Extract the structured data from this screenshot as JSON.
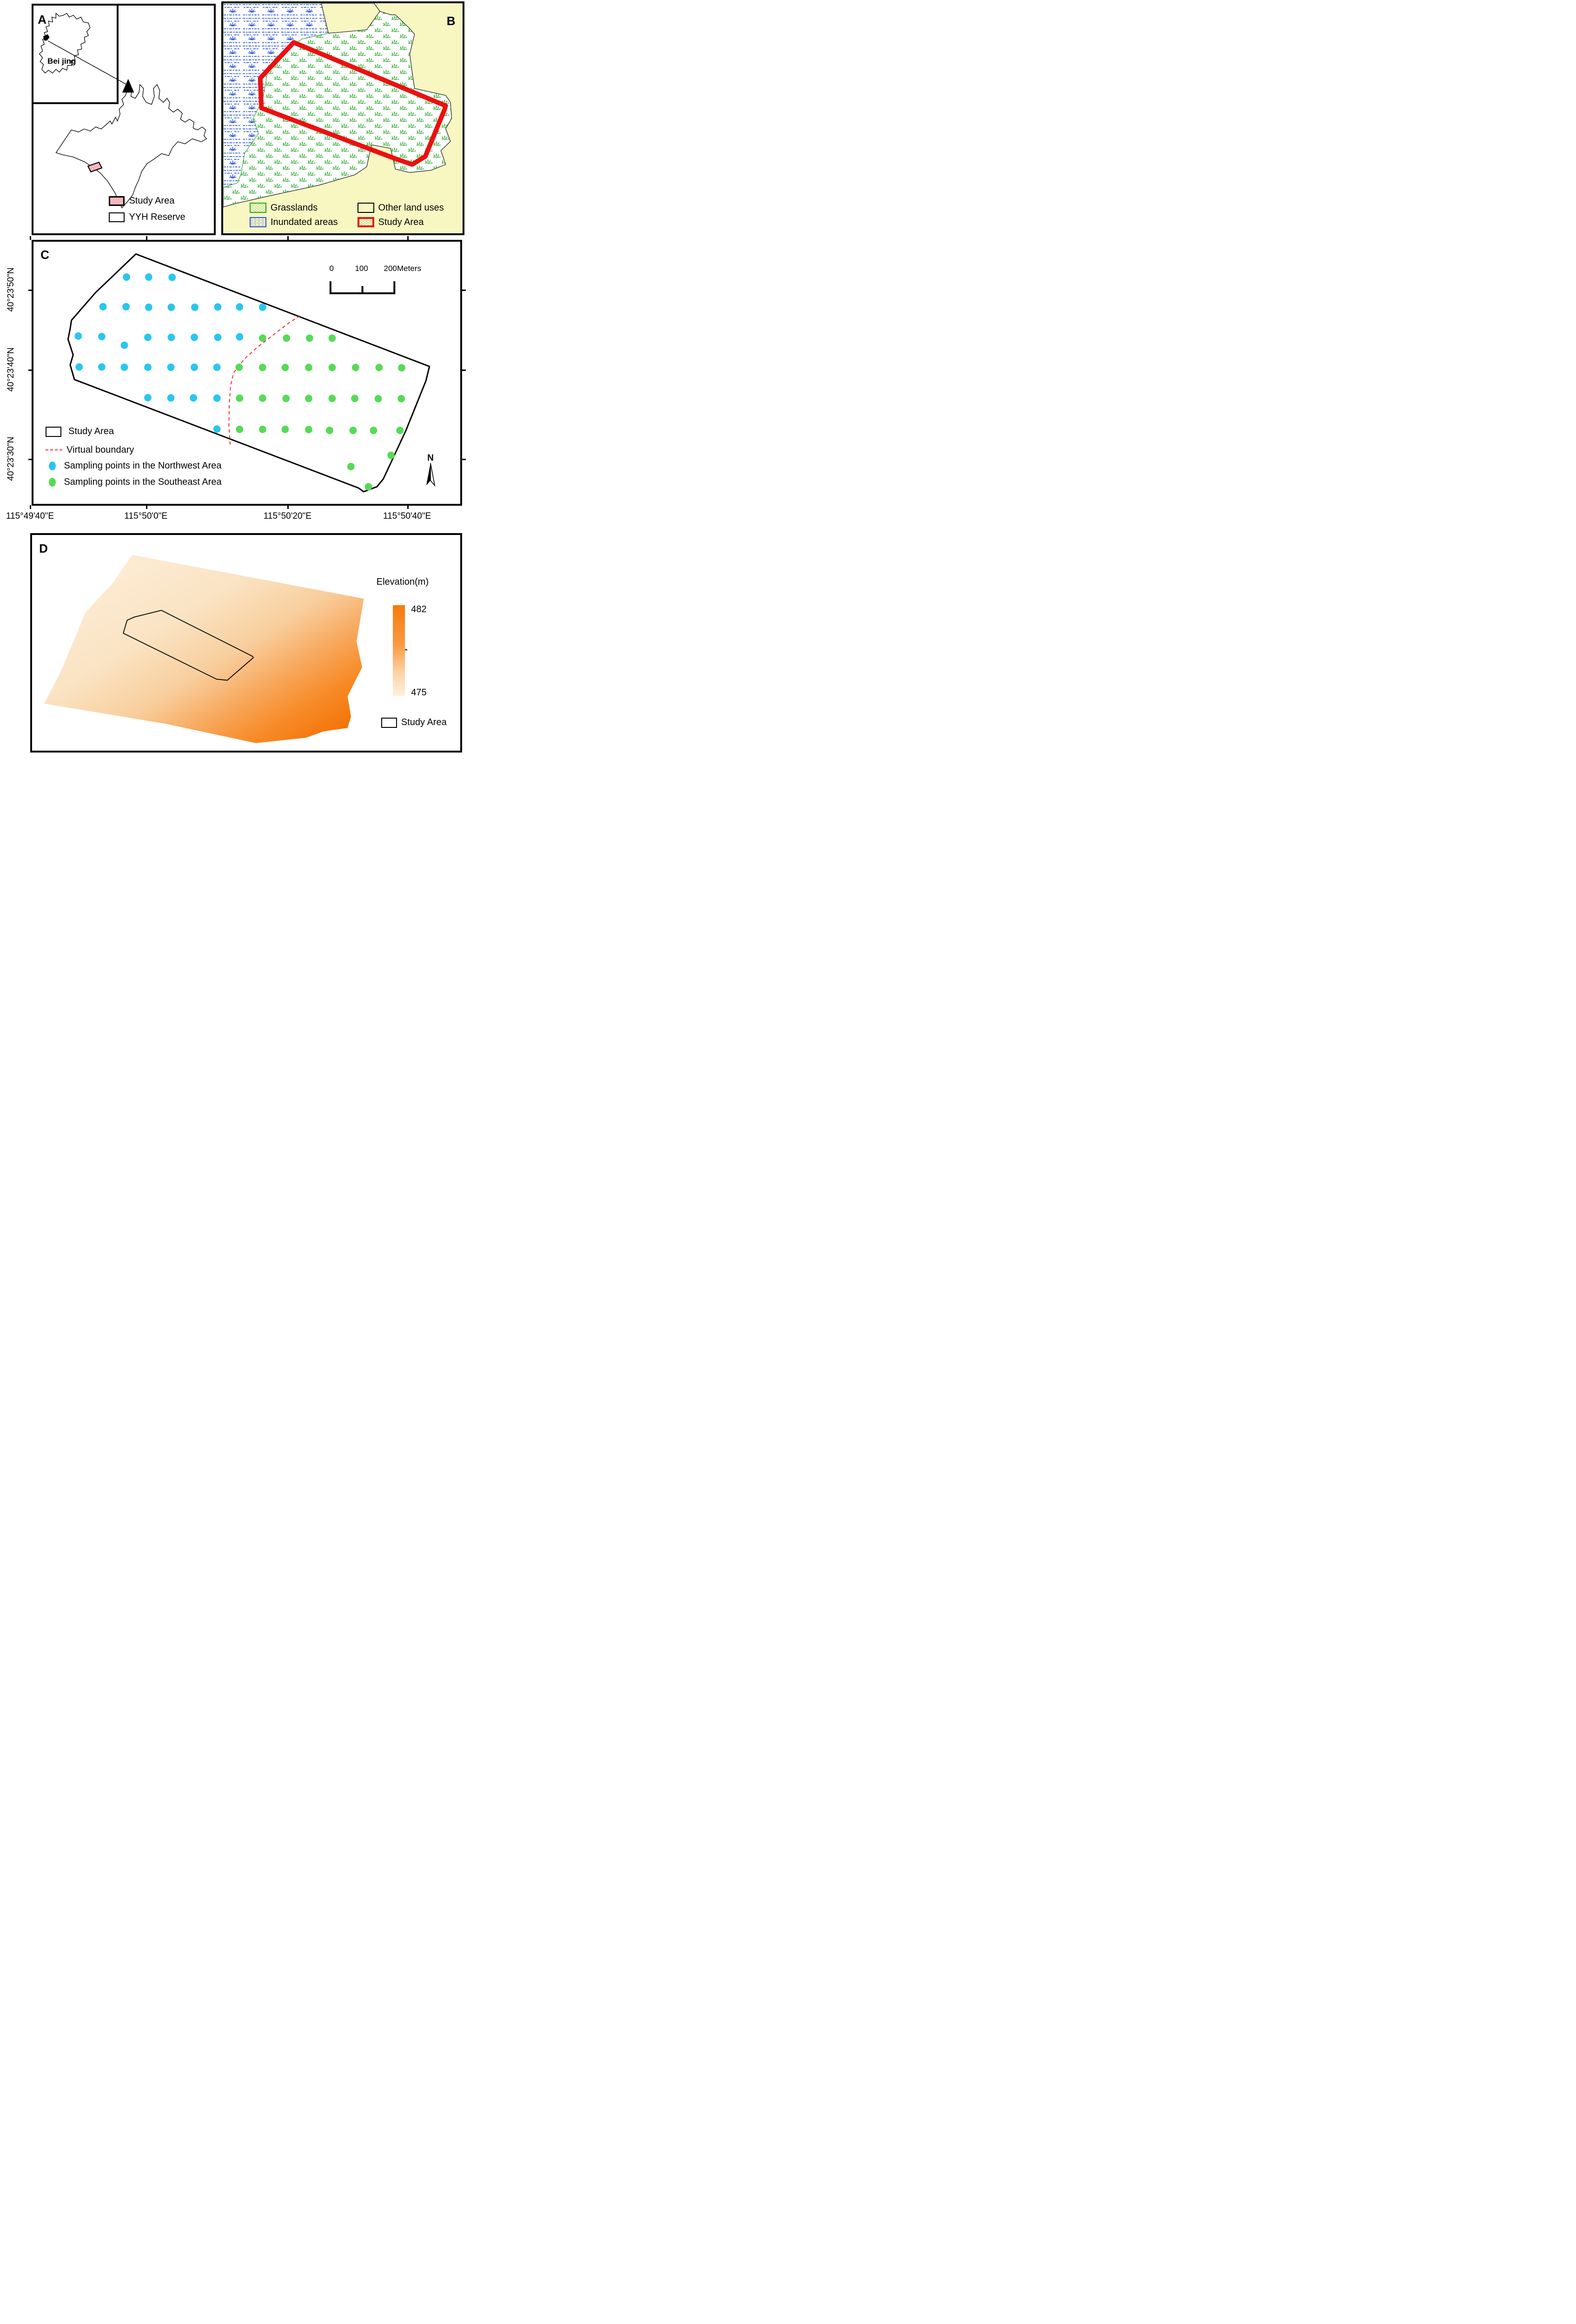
{
  "colors": {
    "page_bg": "#ffffff",
    "panel_b_bg": "#F8F7C2",
    "study_pink": "#F6B6BB",
    "grass_green": "#1FA41F",
    "marsh_blue": "#2A52D8",
    "study_red": "#EC1010",
    "virtual_red": "#FF2A2A",
    "nw_cyan": "#29C6F0",
    "se_green": "#55DB55",
    "elev_high": "#F3750A",
    "elev_low": "#FDEFDC"
  },
  "panel_a": {
    "letter": "A",
    "inset_label": "Bei jing",
    "legend": [
      {
        "label": "Study Area"
      },
      {
        "label": "YYH Reserve"
      }
    ]
  },
  "panel_b": {
    "letter": "B",
    "legend": [
      {
        "label": "Grasslands"
      },
      {
        "label": "Inundated areas"
      },
      {
        "label": "Other land uses"
      },
      {
        "label": "Study Area"
      }
    ]
  },
  "panel_c": {
    "letter": "C",
    "north_label": "N",
    "scale_bar": {
      "labels": [
        "0",
        "100",
        "200"
      ],
      "unit": "Meters"
    },
    "legend": [
      {
        "label": "Study Area"
      },
      {
        "label": "Virtual boundary"
      },
      {
        "label": "Sampling points in the Northwest Area"
      },
      {
        "label": "Sampling points in the Southeast Area"
      }
    ],
    "sampling_points": {
      "northwest": [
        [
          21.8,
          13.5
        ],
        [
          27.0,
          13.5
        ],
        [
          32.5,
          13.6
        ],
        [
          16.3,
          24.8
        ],
        [
          21.7,
          24.8
        ],
        [
          27.0,
          25.0
        ],
        [
          32.3,
          25.0
        ],
        [
          37.8,
          25.0
        ],
        [
          43.2,
          24.9
        ],
        [
          48.3,
          24.9
        ],
        [
          53.7,
          25.0
        ],
        [
          10.5,
          36.0
        ],
        [
          16.0,
          36.2
        ],
        [
          26.8,
          36.5
        ],
        [
          32.3,
          36.5
        ],
        [
          37.7,
          36.5
        ],
        [
          43.2,
          36.5
        ],
        [
          48.3,
          36.3
        ],
        [
          21.3,
          39.5
        ],
        [
          10.7,
          47.8
        ],
        [
          16.0,
          47.8
        ],
        [
          21.3,
          47.9
        ],
        [
          26.8,
          47.9
        ],
        [
          32.2,
          47.9
        ],
        [
          37.7,
          47.9
        ],
        [
          43.0,
          47.9
        ],
        [
          26.8,
          59.5
        ],
        [
          32.2,
          59.6
        ],
        [
          37.5,
          59.6
        ],
        [
          43.0,
          59.7
        ],
        [
          43.0,
          71.5
        ]
      ],
      "southeast": [
        [
          53.7,
          36.8
        ],
        [
          59.3,
          36.8
        ],
        [
          64.7,
          36.8
        ],
        [
          70.0,
          36.8
        ],
        [
          48.2,
          47.9
        ],
        [
          53.7,
          48.0
        ],
        [
          59.0,
          48.0
        ],
        [
          64.5,
          48.0
        ],
        [
          70.0,
          48.0
        ],
        [
          75.5,
          48.0
        ],
        [
          81.0,
          48.0
        ],
        [
          86.3,
          48.1
        ],
        [
          48.3,
          59.7
        ],
        [
          53.7,
          59.7
        ],
        [
          59.2,
          59.8
        ],
        [
          64.5,
          59.8
        ],
        [
          70.0,
          59.8
        ],
        [
          75.3,
          59.8
        ],
        [
          80.8,
          59.9
        ],
        [
          86.2,
          59.9
        ],
        [
          48.3,
          71.6
        ],
        [
          53.7,
          71.6
        ],
        [
          59.0,
          71.6
        ],
        [
          64.5,
          71.7
        ],
        [
          69.4,
          72.0
        ],
        [
          74.9,
          72.0
        ],
        [
          79.7,
          72.0
        ],
        [
          85.9,
          72.0
        ],
        [
          74.4,
          85.8
        ],
        [
          83.8,
          81.5
        ],
        [
          78.5,
          93.5
        ]
      ]
    }
  },
  "axes": {
    "x": {
      "labels": [
        "115°49'40\"E",
        "115°50'0\"E",
        "115°50'20\"E",
        "115°50'40\"E"
      ],
      "pos": [
        6.34,
        30.85,
        60.8,
        86.1
      ]
    },
    "y": {
      "labels": [
        "40°23'50\"N",
        "40°23'40\"N",
        "40°23'30\"N"
      ],
      "pos": [
        38.2,
        48.7,
        60.5
      ]
    }
  },
  "panel_d": {
    "letter": "D",
    "colorbar": {
      "title": "Elevation(m)",
      "max": "482",
      "min": "475"
    },
    "legend": [
      {
        "label": "Study Area"
      }
    ]
  }
}
